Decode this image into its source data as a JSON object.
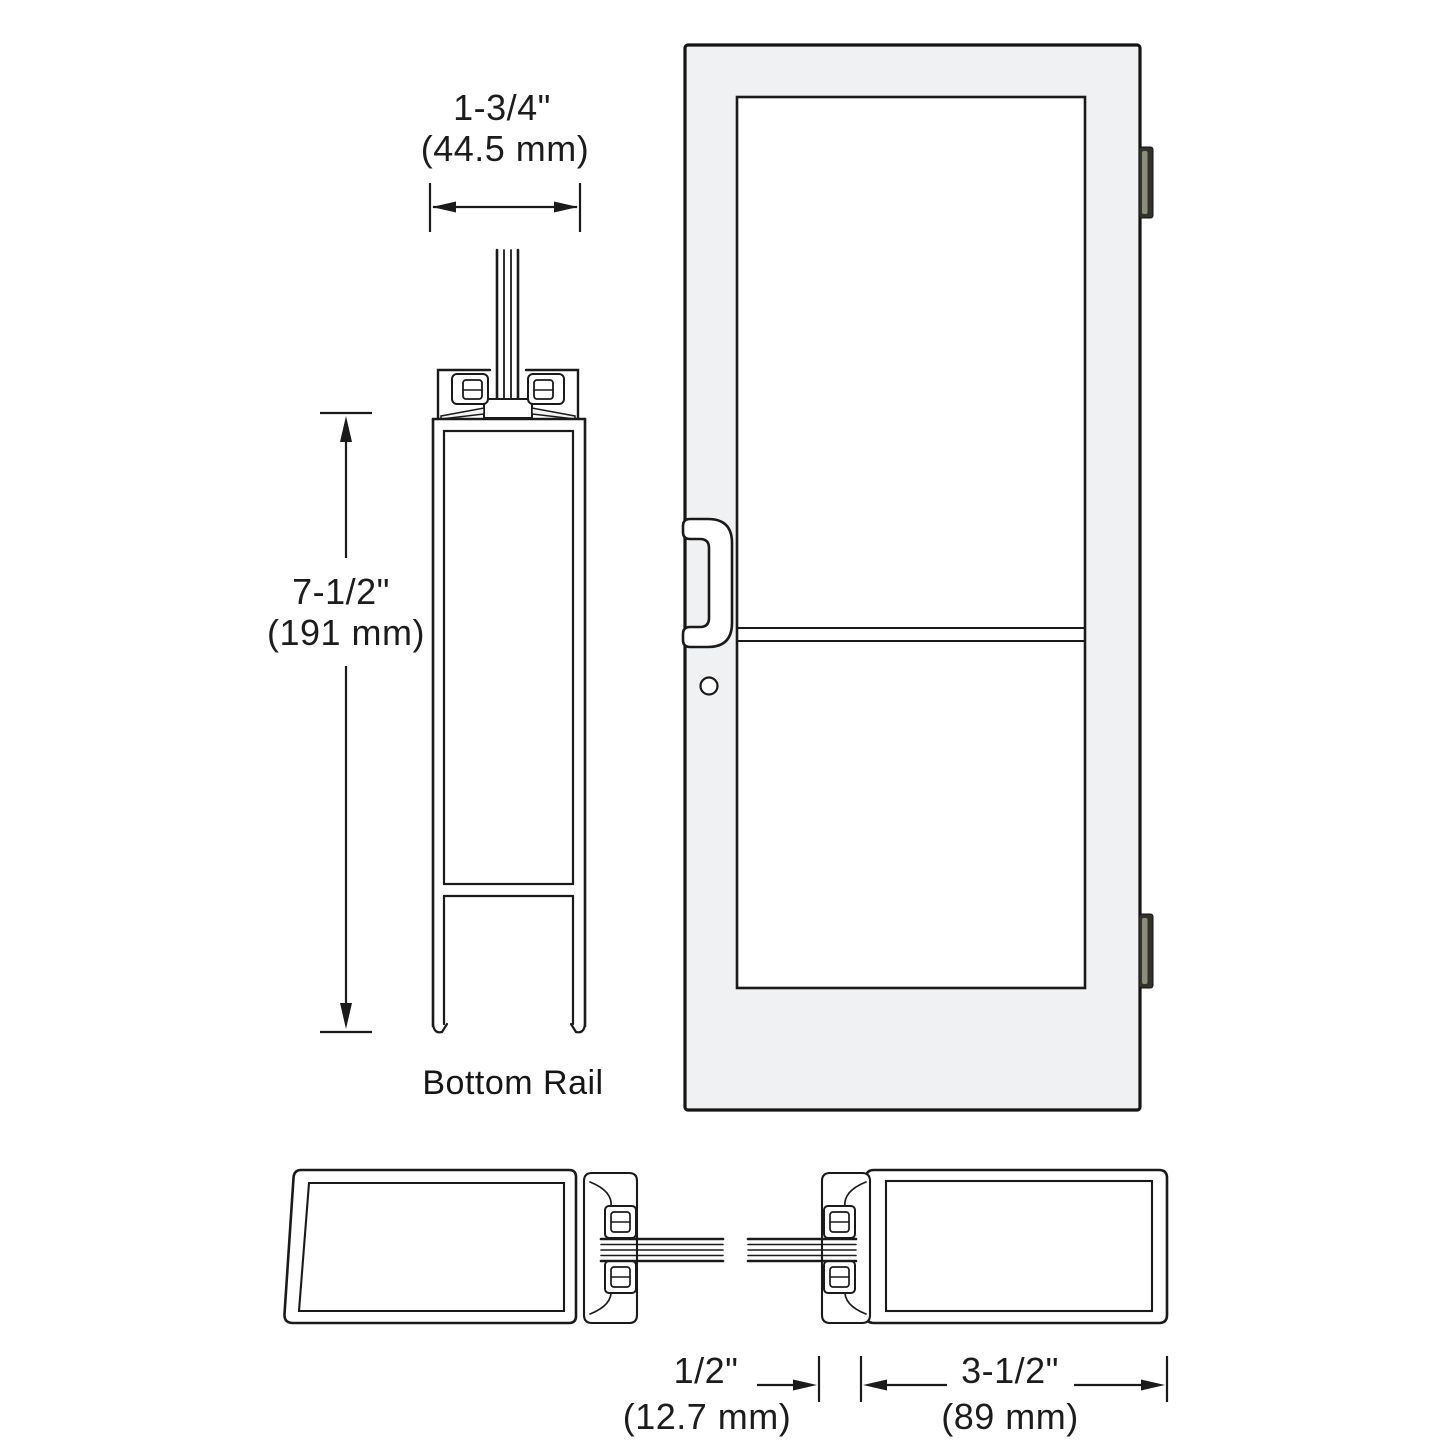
{
  "colors": {
    "line": "#1a1a1a",
    "door_fill": "#f0f1f2",
    "glass": "#ffffff",
    "hinge_dark": "#32322b",
    "hinge_light": "#8d8d7e",
    "wedge_fill": "#f4f4f4"
  },
  "bottom_rail_view": {
    "label": "Bottom Rail",
    "width_in": "1-3/4\"",
    "width_mm": "(44.5 mm)",
    "height_in": "7-1/2\"",
    "height_mm": "(191 mm)"
  },
  "stile_view": {
    "gap_in": "1/2\"",
    "gap_mm": "(12.7 mm)",
    "width_in": "3-1/2\"",
    "width_mm": "(89 mm)"
  }
}
